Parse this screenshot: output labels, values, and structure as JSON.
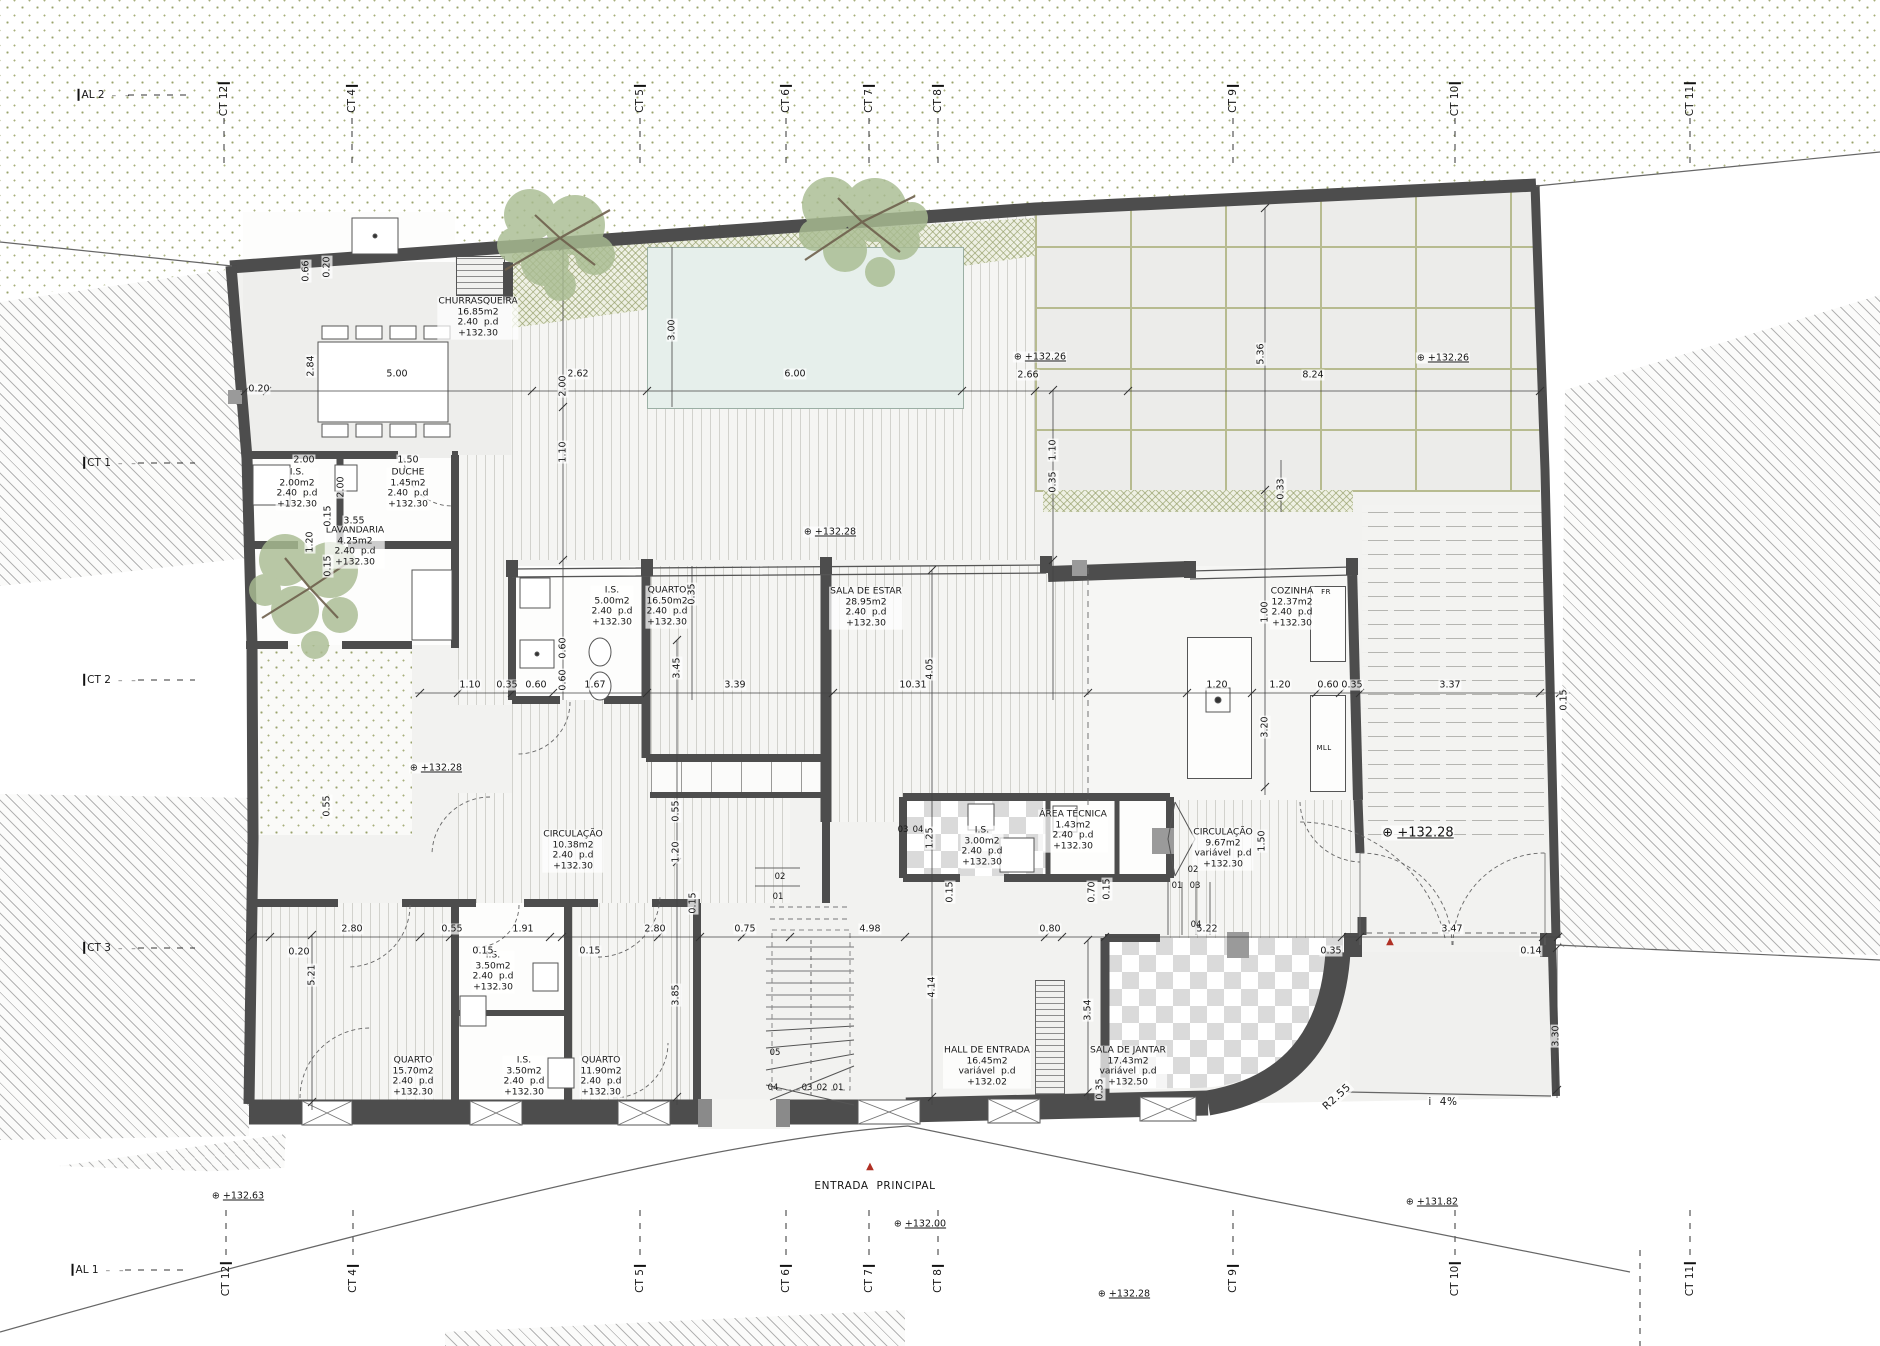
{
  "colors": {
    "wall": "#4d4d4d",
    "pool": "#e6efeb",
    "vegetation_stipple": "#99a36b",
    "stone_joint": "#b7bb90",
    "entry_marker_red": "#b03024",
    "paper": "#ffffff"
  },
  "grid_markers": {
    "top": [
      {
        "label": "AL 2",
        "x": 106,
        "y": 95,
        "orient": "h"
      },
      {
        "label": "CT 12",
        "x": 224,
        "y": 100,
        "orient": "v"
      },
      {
        "label": "CT 4",
        "x": 352,
        "y": 100,
        "orient": "v"
      },
      {
        "label": "CT 5",
        "x": 640,
        "y": 100,
        "orient": "v"
      },
      {
        "label": "CT 6",
        "x": 786,
        "y": 100,
        "orient": "v"
      },
      {
        "label": "CT 7",
        "x": 869,
        "y": 100,
        "orient": "v"
      },
      {
        "label": "CT 8",
        "x": 938,
        "y": 100,
        "orient": "v"
      },
      {
        "label": "CT 9",
        "x": 1233,
        "y": 100,
        "orient": "v"
      },
      {
        "label": "CT 10",
        "x": 1455,
        "y": 100,
        "orient": "v"
      },
      {
        "label": "CT 11",
        "x": 1690,
        "y": 100,
        "orient": "v"
      }
    ],
    "bottom": [
      {
        "label": "AL 1",
        "x": 100,
        "y": 1270,
        "orient": "h"
      },
      {
        "label": "CT 12",
        "x": 226,
        "y": 1280,
        "orient": "v"
      },
      {
        "label": "CT 4",
        "x": 353,
        "y": 1280,
        "orient": "v"
      },
      {
        "label": "CT 5",
        "x": 640,
        "y": 1280,
        "orient": "v"
      },
      {
        "label": "CT 6",
        "x": 786,
        "y": 1280,
        "orient": "v"
      },
      {
        "label": "CT 7",
        "x": 869,
        "y": 1280,
        "orient": "v"
      },
      {
        "label": "CT 8",
        "x": 938,
        "y": 1280,
        "orient": "v"
      },
      {
        "label": "CT 9",
        "x": 1233,
        "y": 1280,
        "orient": "v"
      },
      {
        "label": "CT 10",
        "x": 1455,
        "y": 1280,
        "orient": "v"
      },
      {
        "label": "CT 11",
        "x": 1690,
        "y": 1280,
        "orient": "v"
      }
    ],
    "left": [
      {
        "label": "CT 1",
        "x": 112,
        "y": 463,
        "orient": "h"
      },
      {
        "label": "CT 2",
        "x": 112,
        "y": 680,
        "orient": "h"
      },
      {
        "label": "CT 3",
        "x": 112,
        "y": 948,
        "orient": "h"
      }
    ]
  },
  "rooms": [
    {
      "name": "CHURRASQUEIRA",
      "area": "16.85m2",
      "height": "2.40  p.d",
      "level": "+132.30",
      "x": 478,
      "y": 318
    },
    {
      "name": "I.S.",
      "area": "2.00m2",
      "height": "2.40  p.d",
      "level": "+132.30",
      "x": 297,
      "y": 489
    },
    {
      "name": "DUCHE",
      "area": "1.45m2",
      "height": "2.40  p.d",
      "level": "+132.30",
      "x": 408,
      "y": 489
    },
    {
      "name": "LAVANDARIA",
      "area": "4.25m2",
      "height": "2.40  p.d",
      "level": "+132.30",
      "x": 355,
      "y": 547
    },
    {
      "name": "I.S.",
      "area": "5.00m2",
      "height": "2.40  p.d",
      "level": "+132.30",
      "x": 612,
      "y": 607
    },
    {
      "name": "QUARTO",
      "area": "16.50m2",
      "height": "2.40  p.d",
      "level": "+132.30",
      "x": 667,
      "y": 607
    },
    {
      "name": "SALA DE ESTAR",
      "area": "28.95m2",
      "height": "2.40  p.d",
      "level": "+132.30",
      "x": 866,
      "y": 608
    },
    {
      "name": "COZINHA",
      "area": "12.37m2",
      "height": "2.40  p.d",
      "level": "+132.30",
      "x": 1292,
      "y": 608
    },
    {
      "name": "CIRCULAÇÃO",
      "area": "10.38m2",
      "height": "2.40  p.d",
      "level": "+132.30",
      "x": 573,
      "y": 851
    },
    {
      "name": "I.S.",
      "area": "3.00m2",
      "height": "2.40  p.d",
      "level": "+132.30",
      "x": 982,
      "y": 847
    },
    {
      "name": "ÁREA TÉCNICA",
      "area": "1.43m2",
      "height": "2.40  p.d",
      "level": "+132.30",
      "x": 1073,
      "y": 831
    },
    {
      "name": "CIRCULAÇÃO",
      "area": "9.67m2",
      "height": "variável  p.d",
      "level": "+132.30",
      "x": 1223,
      "y": 849
    },
    {
      "name": "HALL DE ENTRADA",
      "area": "16.45m2",
      "height": "variável  p.d",
      "level": "+132.02",
      "x": 987,
      "y": 1067
    },
    {
      "name": "SALA DE JANTAR",
      "area": "17.43m2",
      "height": "variável  p.d",
      "level": "+132.50",
      "x": 1128,
      "y": 1067
    },
    {
      "name": "QUARTO",
      "area": "15.70m2",
      "height": "2.40  p.d",
      "level": "+132.30",
      "x": 413,
      "y": 1077
    },
    {
      "name": "I.S.",
      "area": "3.50m2",
      "height": "2.40  p.d",
      "level": "+132.30",
      "x": 493,
      "y": 972
    },
    {
      "name": "I.S.",
      "area": "3.50m2",
      "height": "2.40  p.d",
      "level": "+132.30",
      "x": 524,
      "y": 1077
    },
    {
      "name": "QUARTO",
      "area": "11.90m2",
      "height": "2.40  p.d",
      "level": "+132.30",
      "x": 601,
      "y": 1077
    }
  ],
  "dimensions": [
    {
      "t": "0.66",
      "x": 306,
      "y": 271,
      "r": 1
    },
    {
      "t": "0.20",
      "x": 327,
      "y": 267,
      "r": 1
    },
    {
      "t": "2.84",
      "x": 311,
      "y": 366,
      "r": 1
    },
    {
      "t": "0.20",
      "x": 259,
      "y": 389,
      "r": 0
    },
    {
      "t": "5.00",
      "x": 397,
      "y": 374,
      "r": 0
    },
    {
      "t": "2.62",
      "x": 578,
      "y": 374,
      "r": 0
    },
    {
      "t": "6.00",
      "x": 795,
      "y": 374,
      "r": 0
    },
    {
      "t": "2.66",
      "x": 1028,
      "y": 375,
      "r": 0
    },
    {
      "t": "8.24",
      "x": 1313,
      "y": 375,
      "r": 0
    },
    {
      "t": "3.00",
      "x": 672,
      "y": 330,
      "r": 1
    },
    {
      "t": "5.36",
      "x": 1261,
      "y": 354,
      "r": 1
    },
    {
      "t": "0.33",
      "x": 1281,
      "y": 489,
      "r": 1
    },
    {
      "t": "2.00",
      "x": 304,
      "y": 460,
      "r": 0
    },
    {
      "t": "1.50",
      "x": 408,
      "y": 460,
      "r": 0
    },
    {
      "t": "2.00",
      "x": 341,
      "y": 487,
      "r": 1
    },
    {
      "t": "3.55",
      "x": 354,
      "y": 521,
      "r": 0
    },
    {
      "t": "0.15",
      "x": 328,
      "y": 516,
      "r": 1
    },
    {
      "t": "1.20",
      "x": 310,
      "y": 542,
      "r": 1
    },
    {
      "t": "0.15",
      "x": 328,
      "y": 566,
      "r": 1
    },
    {
      "t": "2.00",
      "x": 563,
      "y": 386,
      "r": 1
    },
    {
      "t": "1.10",
      "x": 563,
      "y": 452,
      "r": 1
    },
    {
      "t": "1.10",
      "x": 1053,
      "y": 450,
      "r": 1
    },
    {
      "t": "0.35",
      "x": 1053,
      "y": 482,
      "r": 1
    },
    {
      "t": "1.10",
      "x": 470,
      "y": 685,
      "r": 0
    },
    {
      "t": "0.35",
      "x": 507,
      "y": 685,
      "r": 0
    },
    {
      "t": "0.60",
      "x": 536,
      "y": 685,
      "r": 0
    },
    {
      "t": "1.67",
      "x": 595,
      "y": 685,
      "r": 0
    },
    {
      "t": "3.39",
      "x": 735,
      "y": 685,
      "r": 0
    },
    {
      "t": "10.31",
      "x": 913,
      "y": 685,
      "r": 0
    },
    {
      "t": "4.05",
      "x": 930,
      "y": 669,
      "r": 1
    },
    {
      "t": "3.45",
      "x": 677,
      "y": 668,
      "r": 1
    },
    {
      "t": "0.35",
      "x": 692,
      "y": 594,
      "r": 1
    },
    {
      "t": "0.60",
      "x": 563,
      "y": 648,
      "r": 1
    },
    {
      "t": "0.60",
      "x": 563,
      "y": 680,
      "r": 1
    },
    {
      "t": "1.20",
      "x": 1217,
      "y": 685,
      "r": 0
    },
    {
      "t": "1.20",
      "x": 1280,
      "y": 685,
      "r": 0
    },
    {
      "t": "0.60",
      "x": 1328,
      "y": 685,
      "r": 0
    },
    {
      "t": "0.35",
      "x": 1352,
      "y": 685,
      "r": 0
    },
    {
      "t": "3.37",
      "x": 1450,
      "y": 685,
      "r": 0
    },
    {
      "t": "0.15",
      "x": 1564,
      "y": 700,
      "r": 1
    },
    {
      "t": "1.00",
      "x": 1265,
      "y": 612,
      "r": 1
    },
    {
      "t": "3.20",
      "x": 1265,
      "y": 727,
      "r": 1
    },
    {
      "t": "0.20",
      "x": 299,
      "y": 952,
      "r": 0
    },
    {
      "t": "2.80",
      "x": 352,
      "y": 929,
      "r": 0
    },
    {
      "t": "0.55",
      "x": 452,
      "y": 929,
      "r": 0
    },
    {
      "t": "1.91",
      "x": 523,
      "y": 929,
      "r": 0
    },
    {
      "t": "0.15",
      "x": 483,
      "y": 951,
      "r": 0
    },
    {
      "t": "2.80",
      "x": 655,
      "y": 929,
      "r": 0
    },
    {
      "t": "0.15",
      "x": 590,
      "y": 951,
      "r": 0
    },
    {
      "t": "0.75",
      "x": 745,
      "y": 929,
      "r": 0
    },
    {
      "t": "4.98",
      "x": 870,
      "y": 929,
      "r": 0
    },
    {
      "t": "0.80",
      "x": 1050,
      "y": 929,
      "r": 0
    },
    {
      "t": "5.22",
      "x": 1207,
      "y": 929,
      "r": 0
    },
    {
      "t": "0.35",
      "x": 1331,
      "y": 951,
      "r": 0
    },
    {
      "t": "3.47",
      "x": 1452,
      "y": 929,
      "r": 0
    },
    {
      "t": "0.14",
      "x": 1531,
      "y": 951,
      "r": 0
    },
    {
      "t": "5.21",
      "x": 312,
      "y": 975,
      "r": 1
    },
    {
      "t": "3.85",
      "x": 676,
      "y": 995,
      "r": 1
    },
    {
      "t": "4.14",
      "x": 932,
      "y": 987,
      "r": 1
    },
    {
      "t": "3.54",
      "x": 1088,
      "y": 1010,
      "r": 1
    },
    {
      "t": "0.35",
      "x": 1100,
      "y": 1089,
      "r": 1
    },
    {
      "t": "3.30",
      "x": 1556,
      "y": 1036,
      "r": 1
    },
    {
      "t": "0.15",
      "x": 693,
      "y": 903,
      "r": 1
    },
    {
      "t": "1.20",
      "x": 676,
      "y": 852,
      "r": 1
    },
    {
      "t": "0.55",
      "x": 676,
      "y": 811,
      "r": 1
    },
    {
      "t": "0.55",
      "x": 327,
      "y": 806,
      "r": 1
    },
    {
      "t": "0.15",
      "x": 950,
      "y": 892,
      "r": 1
    },
    {
      "t": "0.70",
      "x": 1092,
      "y": 892,
      "r": 1
    },
    {
      "t": "0.15",
      "x": 1107,
      "y": 889,
      "r": 1
    },
    {
      "t": "1.50",
      "x": 1262,
      "y": 841,
      "r": 1
    },
    {
      "t": "1.25",
      "x": 930,
      "y": 838,
      "r": 1
    }
  ],
  "levels": [
    {
      "t": "+132.26",
      "x": 1040,
      "y": 357,
      "big": 0
    },
    {
      "t": "+132.26",
      "x": 1443,
      "y": 358,
      "big": 0
    },
    {
      "t": "+132.28",
      "x": 830,
      "y": 532,
      "big": 0
    },
    {
      "t": "+132.28",
      "x": 436,
      "y": 768,
      "big": 0
    },
    {
      "t": "+132.28",
      "x": 1418,
      "y": 833,
      "big": 1
    },
    {
      "t": "+132.63",
      "x": 238,
      "y": 1196,
      "big": 0
    },
    {
      "t": "+132.00",
      "x": 920,
      "y": 1224,
      "big": 0
    },
    {
      "t": "+132.28",
      "x": 1124,
      "y": 1294,
      "big": 0
    },
    {
      "t": "+131.82",
      "x": 1432,
      "y": 1202,
      "big": 0
    }
  ],
  "annotations": [
    {
      "t": "ENTRADA  PRINCIPAL",
      "x": 875,
      "y": 1186,
      "r": 0
    },
    {
      "t": "i  4%",
      "x": 1443,
      "y": 1102,
      "r": 0
    },
    {
      "t": "R2.55",
      "x": 1337,
      "y": 1097,
      "r": -42
    }
  ],
  "entry_markers": [
    {
      "t": "▲",
      "x": 870,
      "y": 1167
    },
    {
      "t": "▲",
      "x": 1390,
      "y": 942
    }
  ],
  "appliance_labels": [
    {
      "t": "FR",
      "x": 1326,
      "y": 592
    },
    {
      "t": "MLL",
      "x": 1324,
      "y": 748
    }
  ],
  "step_numbers": [
    {
      "t": "05",
      "x": 775,
      "y": 1054
    },
    {
      "t": "04",
      "x": 773,
      "y": 1089
    },
    {
      "t": "03",
      "x": 807,
      "y": 1089
    },
    {
      "t": "02",
      "x": 822,
      "y": 1089
    },
    {
      "t": "01",
      "x": 838,
      "y": 1089
    },
    {
      "t": "02",
      "x": 780,
      "y": 878
    },
    {
      "t": "01",
      "x": 778,
      "y": 898
    },
    {
      "t": "02",
      "x": 1193,
      "y": 871
    },
    {
      "t": "01",
      "x": 1177,
      "y": 887
    },
    {
      "t": "03",
      "x": 1195,
      "y": 887
    },
    {
      "t": "04",
      "x": 1196,
      "y": 926
    },
    {
      "t": "03",
      "x": 903,
      "y": 831
    },
    {
      "t": "04",
      "x": 918,
      "y": 831
    }
  ]
}
